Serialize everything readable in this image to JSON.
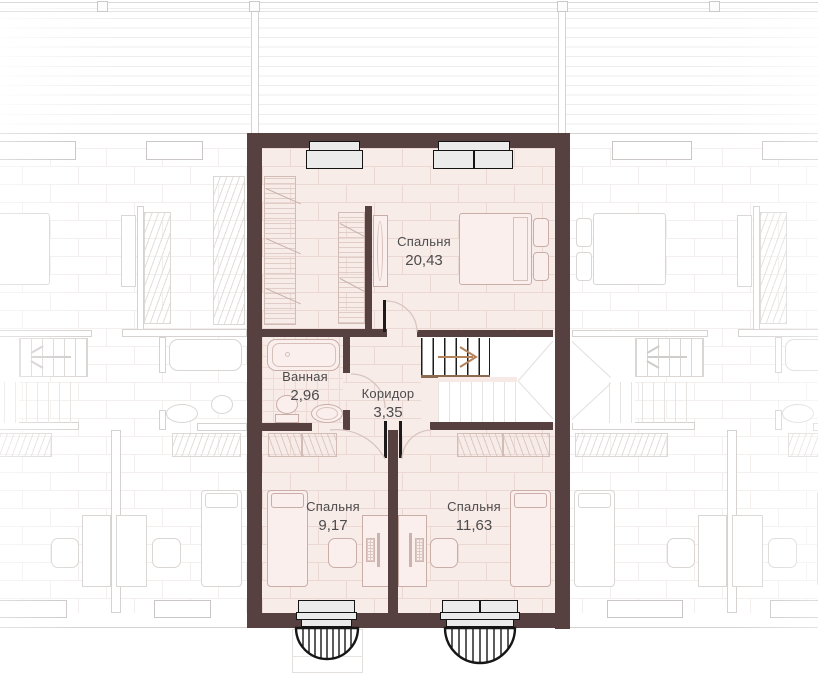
{
  "plan": {
    "rooms": [
      {
        "name": "Спальня",
        "area": "20,43"
      },
      {
        "name": "Ванная",
        "area": "2,96"
      },
      {
        "name": "Коридор",
        "area": "3,35"
      },
      {
        "name": "Спальня",
        "area": "9,17"
      },
      {
        "name": "Спальня",
        "area": "11,63"
      }
    ],
    "icons": {
      "stair_direction_main_unit": "arrow-right",
      "stair_direction_adjacent_units": "arrow-left"
    },
    "colors": {
      "wall": "#564140",
      "floor": "#f8ece9",
      "floor_joint_line": "#ecd8d3",
      "stair_arrow_accent": "#b5835a",
      "window_fill": "#ebebeb",
      "label_text": "#4c4c4c",
      "adjacent_unit_line": "#d9d6d4"
    }
  }
}
